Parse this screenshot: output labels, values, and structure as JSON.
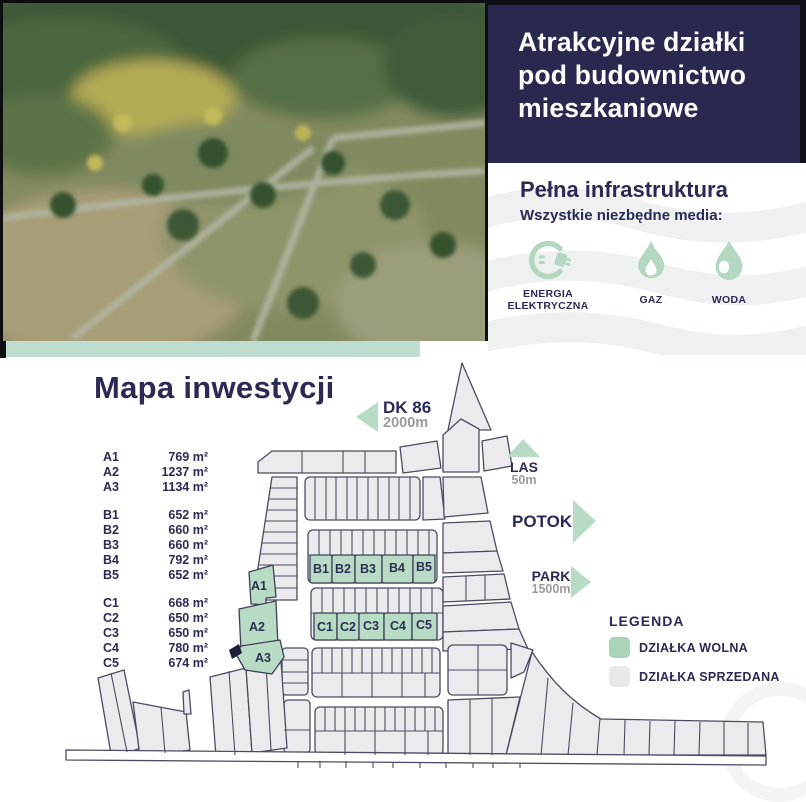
{
  "hero": {
    "title_lines": [
      "Atrakcyjne działki",
      "pod budownictwo",
      "mieszkaniowe"
    ]
  },
  "infrastructure": {
    "heading": "Pełna infrastruktura",
    "subheading": "Wszystkie niezbędne media:",
    "items": [
      {
        "icon": "electric-plug-icon",
        "line1": "ENERGIA",
        "line2": "ELEKTRYCZNA"
      },
      {
        "icon": "flame-icon",
        "line1": "GAZ"
      },
      {
        "icon": "water-drop-icon",
        "line1": "WODA"
      }
    ]
  },
  "map": {
    "title": "Mapa inwestycji",
    "landmarks": {
      "dk86": {
        "name": "DK 86",
        "distance": "2000m",
        "direction": "left"
      },
      "las": {
        "name": "LAS",
        "distance": "50m",
        "direction": "up"
      },
      "potok": {
        "name": "POTOK",
        "direction": "right"
      },
      "park": {
        "name": "PARK",
        "distance": "1500m",
        "direction": "right"
      }
    },
    "free_plot_labels": {
      "a1": "A1",
      "a2": "A2",
      "a3": "A3",
      "b1": "B1",
      "b2": "B2",
      "b3": "B3",
      "b4": "B4",
      "b5": "B5",
      "c1": "C1",
      "c2": "C2",
      "c3": "C3",
      "c4": "C4",
      "c5": "C5"
    },
    "legend": {
      "title": "LEGENDA",
      "free_label": "DZIAŁKA WOLNA",
      "sold_label": "DZIAŁKA SPRZEDANA"
    }
  },
  "plot_list": {
    "groups": [
      {
        "rows": [
          {
            "id": "A1",
            "area": "769 m²"
          },
          {
            "id": "A2",
            "area": "1237 m²"
          },
          {
            "id": "A3",
            "area": "1134 m²"
          }
        ]
      },
      {
        "rows": [
          {
            "id": "B1",
            "area": "652 m²"
          },
          {
            "id": "B2",
            "area": "660 m²"
          },
          {
            "id": "B3",
            "area": "660 m²"
          },
          {
            "id": "B4",
            "area": "792 m²"
          },
          {
            "id": "B5",
            "area": "652 m²"
          }
        ]
      },
      {
        "rows": [
          {
            "id": "C1",
            "area": "668 m²"
          },
          {
            "id": "C2",
            "area": "650 m²"
          },
          {
            "id": "C3",
            "area": "650 m²"
          },
          {
            "id": "C4",
            "area": "780 m²"
          },
          {
            "id": "C5",
            "area": "674 m²"
          }
        ]
      }
    ]
  },
  "colors": {
    "navy": "#29284f",
    "accent_green": "#b7dbc5",
    "legend_green": "#a8d3b7",
    "sold_fill": "#ebebee",
    "text_navy": "#2b2a55",
    "muted_gray": "#9b9b9b"
  }
}
